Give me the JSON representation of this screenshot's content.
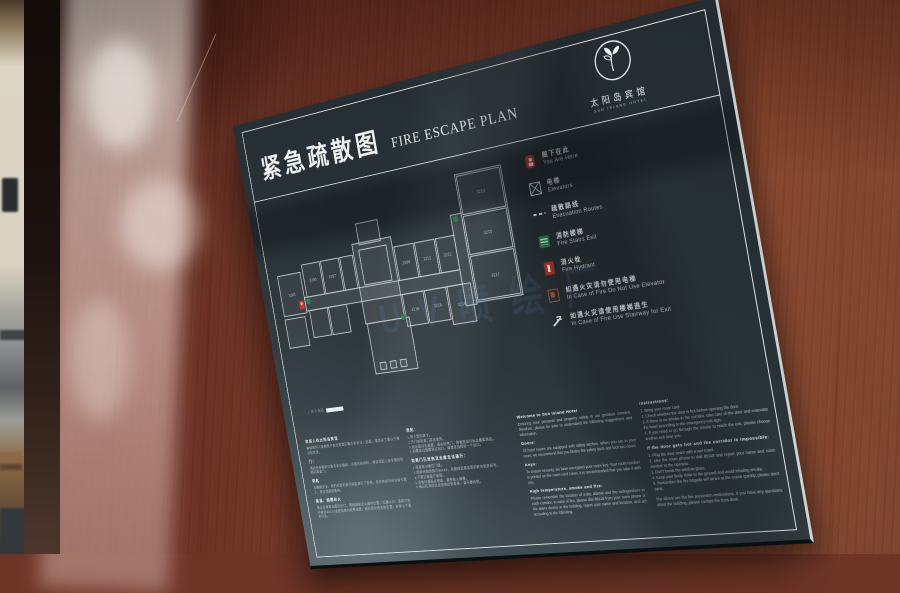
{
  "sign": {
    "title_zh": "紧急疏散图",
    "title_en": "FIRE ESCAPE PLAN",
    "logo": {
      "name_zh": "太阳岛宾馆",
      "name_en": "SUN ISLAND HOTEL"
    },
    "watermark": "UV喷绘厂",
    "floor_plan": {
      "label": "三楼平面图",
      "room_numbers": [
        "3201",
        "3205",
        "3207",
        "3209",
        "3211",
        "3212",
        "3213",
        "3215",
        "3216",
        "3217",
        "3218",
        "3219"
      ]
    },
    "legend": [
      {
        "icon": "you-are-here-icon",
        "zh": "阁下在此",
        "en": "You Are Here",
        "color": "#c63b2f"
      },
      {
        "icon": "elevator-icon",
        "zh": "电梯",
        "en": "Elevators",
        "color": "#eef1f1"
      },
      {
        "icon": "evacuation-route-icon",
        "zh": "疏散路线",
        "en": "Evacuation Routes",
        "color": "#eef1f1"
      },
      {
        "icon": "fire-stairs-icon",
        "zh": "消防楼梯",
        "en": "Fire Stairs Exit",
        "color": "#2f7c52"
      },
      {
        "icon": "fire-hydrant-icon",
        "zh": "消火栓",
        "en": "Fire Hydrant",
        "color": "#b6372b"
      },
      {
        "icon": "no-elevator-icon",
        "zh": "如遇火灾请勿使用电梯",
        "en": "In Case of Fire Do Not Use Elevator",
        "color": "#c05a4a"
      },
      {
        "icon": "stairway-exit-icon",
        "zh": "如遇火灾请使用楼梯逃生",
        "en": "In Case of Fire Use Stairway for Exit",
        "color": "#eef1f1"
      }
    ],
    "notice_zh_col1": {
      "welcome_head": "欢迎入住太阳岛宾馆",
      "welcome_body": "确保您的人身和财产安全是我们最大的关注，因此，请务必了解以下建议和信息。",
      "doors_head": "门：",
      "doors_body": "酒店所有客房均装有安全锁扣，当您在房间时，建议您扣上安全锁扣并锁好两道门。",
      "keys_head": "钥匙",
      "keys_body": "为确保安全，我们对您的房间钥匙进行了加密，您的房间号印在房卡套上，建议您随身携带。",
      "fire_head": "高温、烟雾和火",
      "fire_body": "请记住每条走廊的出口、警报器和灭火器的位置。如遇火灾，请拨打房间电话88119或使用楼内报警装置，报告您的姓名和位置，并按以下要求行动。"
    },
    "notice_zh_col2": {
      "inst_head": "须知：",
      "inst_body": "1.带上您的房卡。\n2.开门前检查门是否发热。\n3.如走廊内无烟雾，请关好房门，按紧急出口标志撤离酒店。\n4.如需穿过烟雾到达出口，请就近选择另一个出口。",
      "hot_head": "如果门已发热且走廊无法通行：",
      "hot_body": "1.用湿毛巾堵住门缝。\n2.用房间电话拨打88119，向接线员报告您的姓名和房间号。\n3.不要打破窗户玻璃。\n4.身体尽量贴近地面，避免吸入烟雾。\n5.请记住消防队会很快赶到现场，请不要惊慌。"
    },
    "notice_en_col1": {
      "welcome_head": "Welcome to Sun Island Hotel",
      "welcome_body": "Ensuring your personal and property safety is our greatest concern, therefore, please be sure to understand the following suggestions and information.",
      "doors_head": "Doors:",
      "doors_body": "All hotel rooms are equipped with safety latches. When you are in your room, we recommend that you fasten the safety latch and lock two doors.",
      "keys_head": "Keys:",
      "keys_body": "To ensure security, we have encrypted your room key. Your room number is printed on the room card cover, it is recommended that you take it with you.",
      "fire_head": "High temperature, smoke and fire:",
      "fire_body": "Please remember the location of exits, alarms and fire extinguishers in each corridor. In case of fire, please dial 88119 from your room phone or the alarm device in the building, report your name and location, and act according to the following."
    },
    "notice_en_col2": {
      "inst_head": "Instructions:",
      "inst_body": "1. Bring your room card.\n2. Check whether the door is hot before opening the door.\n3. If there is no smoke in the corridor, take care of the door and evacuate the hotel according to the emergency exit sign.\n4. If you need to go through the smoke to reach the exit, please choose another exit near you.",
      "hot_head": "If the door gets hot and the corridor is impossible:",
      "hot_body": "1. Plug the door seam with a wet towel.\n2. Use the room phone to dial 88119 and report your name and room number to the operator.\n3. Don't break the window glass.\n4. Keep your body close to the ground and avoid inhaling smoke.\n5. Remember the fire brigade will arrive at the scene quickly, please don't panic.",
      "closing": "The above are the fire prevention instructions. If you have any questions about the building, please contact the front desk."
    }
  }
}
